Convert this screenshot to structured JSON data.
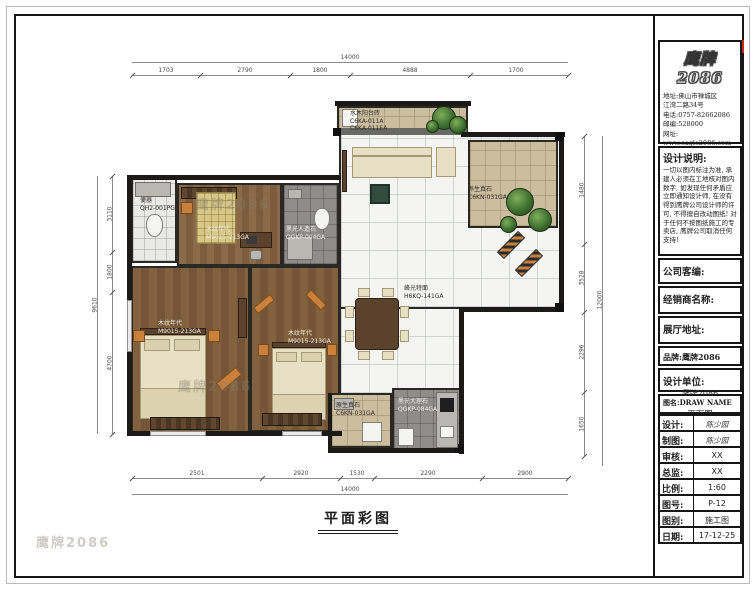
{
  "sheet": {
    "drawing_title": "平面彩图",
    "watermark": "鹰牌2086"
  },
  "title_block": {
    "logo_text": "鹰牌2086",
    "contact_lines": [
      "地址:佛山市禅城区",
      "江湾二路34号",
      "电话:0757-82662086",
      "邮编:528000",
      "网址:",
      "www.eagle2086.com"
    ],
    "design_notes_title": "设计说明:",
    "design_notes": "一切以图内标注为准, 承建人必须在工地核对图内数字, 如发现任何矛盾应立即通知设计师, 在没有得到鹰牌公司设计师的许可, 不得擅自改动图纸! 对于任何不按图纸施工的专卖店, 鹰牌公司取消任何支持!",
    "company_code_label": "公司客编:",
    "dealer_label": "经销商名称:",
    "showroom_label": "展厅地址:",
    "brand_label": "品牌:鹰牌2086",
    "design_unit_label": "设计单位:",
    "design_unit_value": "鹰牌2086",
    "drawing_name_label": "图名:DRAW NAME",
    "drawing_name_value": "平面图",
    "rows": [
      {
        "label": "设计:",
        "value": "陈少园"
      },
      {
        "label": "制图:",
        "value": "陈少园"
      },
      {
        "label": "审核:",
        "value": "XX"
      },
      {
        "label": "总监:",
        "value": "XX"
      },
      {
        "label": "比例:",
        "value": "1:60"
      },
      {
        "label": "图号:",
        "value": "P-12"
      },
      {
        "label": "图别:",
        "value": "施工图"
      },
      {
        "label": "日期:",
        "value": "17-12-25"
      }
    ],
    "accent_color": "#cf2318"
  },
  "plan": {
    "labels": [
      {
        "name": "水木阳台砖",
        "code": "C6KA-011A",
        "code2": "C6KA-011EA"
      },
      {
        "name": "便器",
        "code": "QH2-001PGA"
      },
      {
        "name": "木纹年代",
        "code": "M9015-213GA"
      },
      {
        "name": "黑光人造石",
        "code": "QGKP-004GA"
      },
      {
        "name": "养生真石",
        "code": "C6KN-031GA"
      },
      {
        "name": "峰光特面",
        "code": "H6KQ-141GA"
      },
      {
        "name": "木纹年代",
        "code": "M9015-213GA"
      },
      {
        "name": "木纹年代",
        "code": "M9015-213GA"
      },
      {
        "name": "原生真石",
        "code": "C6KN-031GA"
      },
      {
        "name": "黑光大理石",
        "code": "QGKP-084GA"
      }
    ],
    "dims": {
      "top": {
        "overall": "14000",
        "segments": [
          "1703",
          "2790",
          "1800",
          "4888",
          "1700"
        ]
      },
      "bottom": {
        "overall": "14000",
        "segments": [
          "2501",
          "2920",
          "1530",
          "2290",
          "2900"
        ]
      },
      "left": {
        "overall": "9610",
        "segments": [
          "3110",
          "1800",
          "4700"
        ]
      },
      "right": {
        "overall": "12000",
        "segments": [
          "1480",
          "3528",
          "2296",
          "1650"
        ]
      }
    }
  }
}
